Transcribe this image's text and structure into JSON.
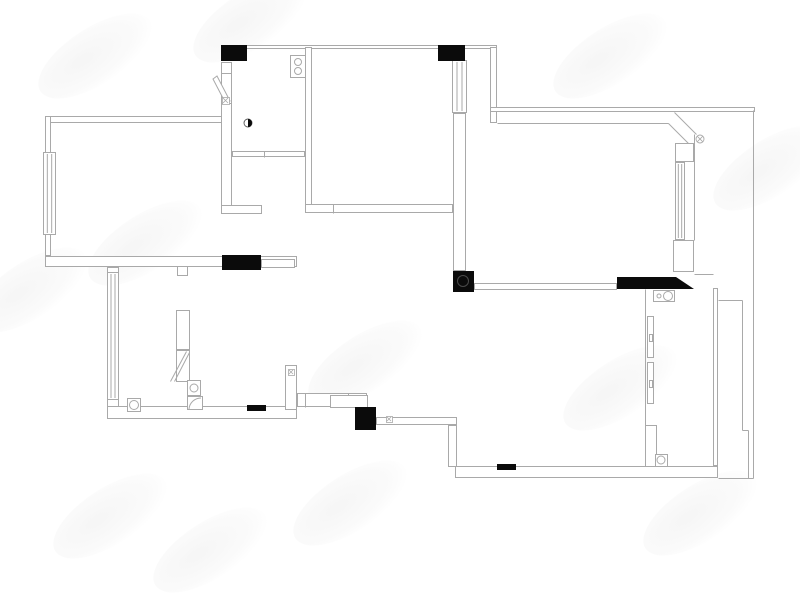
{
  "meta": {
    "kind": "apartment-floor-plan",
    "canvas": {
      "width": 800,
      "height": 567
    },
    "background": "#ffffff"
  },
  "colors": {
    "line": "#a9a9a9",
    "dark": "#0b0b0b",
    "white": "#ffffff",
    "pipe_ring": "#4a4a4a"
  },
  "watermarks": [
    {
      "x": 30,
      "y": 28
    },
    {
      "x": 185,
      "y": -8
    },
    {
      "x": 545,
      "y": 28
    },
    {
      "x": 705,
      "y": 140
    },
    {
      "x": -35,
      "y": 262
    },
    {
      "x": 80,
      "y": 215
    },
    {
      "x": 300,
      "y": 335
    },
    {
      "x": 555,
      "y": 360
    },
    {
      "x": 285,
      "y": 475
    },
    {
      "x": 635,
      "y": 485
    },
    {
      "x": 145,
      "y": 522
    },
    {
      "x": 45,
      "y": 488
    }
  ],
  "plan": {
    "shapes": [
      {
        "t": "rect",
        "n": "top-wall",
        "x": 221,
        "y": 45,
        "w": 276,
        "h": 4
      },
      {
        "t": "rect",
        "n": "left-room-top-wall",
        "x": 45,
        "y": 116,
        "w": 177,
        "h": 7
      },
      {
        "t": "rect",
        "n": "left-room-left-wall",
        "x": 45,
        "y": 116,
        "w": 6,
        "h": 140
      },
      {
        "t": "win",
        "n": "window",
        "x": 43,
        "y": 152,
        "w": 13,
        "h": 83
      },
      {
        "t": "rect",
        "n": "left-room-bottom-wall",
        "x": 45,
        "y": 256,
        "w": 252,
        "h": 11
      },
      {
        "t": "rect",
        "n": "door-lintel",
        "x": 261,
        "y": 259,
        "w": 34,
        "h": 9
      },
      {
        "t": "rect",
        "n": "wall-notch",
        "x": 177,
        "y": 266,
        "w": 11,
        "h": 10
      },
      {
        "t": "rect",
        "n": "entry-door-jamb",
        "x": 221,
        "y": 62,
        "w": 11,
        "h": 12
      },
      {
        "t": "rect",
        "n": "entry-door-frame",
        "x": 221,
        "y": 73,
        "w": 11,
        "h": 32
      },
      {
        "t": "poly",
        "n": "entry-door-leaf",
        "fill": "none",
        "pts": [
          [
            213,
            79
          ],
          [
            217,
            76
          ],
          [
            230,
            101
          ],
          [
            226,
            104
          ]
        ]
      },
      {
        "t": "rect",
        "n": "kitchen-left-wall",
        "x": 221,
        "y": 103,
        "w": 11,
        "h": 107
      },
      {
        "t": "rect",
        "n": "bath-bottom-stub-left",
        "x": 221,
        "y": 205,
        "w": 41,
        "h": 9
      },
      {
        "t": "rect",
        "n": "kitchen-right-wall",
        "x": 305,
        "y": 47,
        "w": 7,
        "h": 158
      },
      {
        "t": "rect",
        "n": "kitchen-bottom-wall",
        "x": 232,
        "y": 151,
        "w": 73,
        "h": 6
      },
      {
        "t": "line",
        "n": "wall-tick",
        "x1": 264,
        "y1": 151,
        "x2": 264,
        "y2": 157
      },
      {
        "t": "rect",
        "n": "living-bottom-wall",
        "x": 305,
        "y": 204,
        "w": 148,
        "h": 9
      },
      {
        "t": "line",
        "n": "wall-tick",
        "x1": 333,
        "y1": 204,
        "x2": 333,
        "y2": 213
      },
      {
        "t": "rect",
        "n": "stove",
        "x": 290,
        "y": 55,
        "w": 16,
        "h": 23
      },
      {
        "t": "circle",
        "n": "stove-burner",
        "cx": 298,
        "cy": 62,
        "r": 3.5
      },
      {
        "t": "circle",
        "n": "stove-burner",
        "cx": 298,
        "cy": 71,
        "r": 3.5
      },
      {
        "t": "sym",
        "n": "meter-symbol",
        "x": 222,
        "y": 97,
        "s": 7
      },
      {
        "t": "rect",
        "n": "lower-left-wall",
        "x": 107,
        "y": 267,
        "w": 12,
        "h": 151
      },
      {
        "t": "win",
        "n": "window",
        "x": 107,
        "y": 272,
        "w": 12,
        "h": 128
      },
      {
        "t": "rect",
        "n": "lower-left-bottom-wall",
        "x": 107,
        "y": 406,
        "w": 190,
        "h": 13
      },
      {
        "t": "rect",
        "n": "floor-drain",
        "x": 127,
        "y": 398,
        "w": 14,
        "h": 14
      },
      {
        "t": "circle",
        "n": "floor-drain-circle",
        "cx": 134,
        "cy": 405,
        "r": 4.5
      },
      {
        "t": "rect",
        "n": "cabinet",
        "x": 176,
        "y": 310,
        "w": 14,
        "h": 40
      },
      {
        "t": "rect",
        "n": "water-heater",
        "x": 176,
        "y": 350,
        "w": 14,
        "h": 32
      },
      {
        "t": "line",
        "n": "brace",
        "x1": 170,
        "y1": 381,
        "x2": 186,
        "y2": 351
      },
      {
        "t": "line",
        "n": "brace",
        "x1": 174,
        "y1": 381,
        "x2": 189,
        "y2": 352
      },
      {
        "t": "rect",
        "n": "toilet-tank",
        "x": 187,
        "y": 380,
        "w": 14,
        "h": 16
      },
      {
        "t": "circle",
        "n": "toilet-circle",
        "cx": 194,
        "cy": 388,
        "r": 4
      },
      {
        "t": "rect",
        "n": "corner-basin",
        "x": 187,
        "y": 396,
        "w": 16,
        "h": 14
      },
      {
        "t": "arc",
        "n": "corner-basin-arc",
        "d": "M 189 409 A 12 12 0 0 1 201 398"
      },
      {
        "t": "rect",
        "n": "hall-jamb",
        "x": 285,
        "y": 365,
        "w": 12,
        "h": 45
      },
      {
        "t": "sym",
        "n": "switch-symbol",
        "x": 288,
        "y": 369,
        "s": 6
      },
      {
        "t": "rect",
        "n": "hall-wall",
        "x": 297,
        "y": 393,
        "w": 70,
        "h": 14
      },
      {
        "t": "line",
        "n": "wall-tick",
        "x1": 305,
        "y1": 393,
        "x2": 305,
        "y2": 407
      },
      {
        "t": "line",
        "n": "wall-tick",
        "x1": 348,
        "y1": 393,
        "x2": 348,
        "y2": 407
      },
      {
        "t": "rect",
        "n": "step-wall",
        "x": 330,
        "y": 395,
        "w": 38,
        "h": 13
      },
      {
        "t": "rect",
        "n": "hall-wall-lower",
        "x": 376,
        "y": 417,
        "w": 81,
        "h": 8
      },
      {
        "t": "sym",
        "n": "switch-symbol",
        "x": 386,
        "y": 416,
        "s": 6
      },
      {
        "t": "rect",
        "n": "hall-wall-vert",
        "x": 448,
        "y": 425,
        "w": 9,
        "h": 42
      },
      {
        "t": "win",
        "n": "window",
        "x": 452,
        "y": 60,
        "w": 15,
        "h": 53
      },
      {
        "t": "rect",
        "n": "bedroom-left-wall",
        "x": 453,
        "y": 113,
        "w": 13,
        "h": 158
      },
      {
        "t": "rect",
        "n": "vestibule-right-wall",
        "x": 490,
        "y": 47,
        "w": 7,
        "h": 76
      },
      {
        "t": "rect",
        "n": "outer-top-wall",
        "x": 490,
        "y": 107,
        "w": 265,
        "h": 5
      },
      {
        "t": "line",
        "n": "bedroom-top-wall",
        "x1": 497,
        "y1": 123,
        "x2": 668,
        "y2": 123
      },
      {
        "t": "line",
        "n": "chamfer-inner",
        "x1": 668,
        "y1": 123,
        "x2": 690,
        "y2": 145
      },
      {
        "t": "line",
        "n": "chamfer-outer",
        "x1": 674,
        "y1": 112,
        "x2": 696,
        "y2": 134
      },
      {
        "t": "rect",
        "n": "bedroom-corner-block",
        "x": 675,
        "y": 143,
        "w": 19,
        "h": 19
      },
      {
        "t": "cx",
        "n": "pipe-symbol",
        "cx": 700,
        "cy": 139,
        "r": 4
      },
      {
        "t": "win",
        "n": "window",
        "x": 675,
        "y": 162,
        "w": 10,
        "h": 78
      },
      {
        "t": "line",
        "n": "bedroom-right-wall-outer",
        "x1": 694,
        "y1": 134,
        "x2": 694,
        "y2": 240
      },
      {
        "t": "rect",
        "n": "window-sill-block",
        "x": 673,
        "y": 240,
        "w": 21,
        "h": 32
      },
      {
        "t": "rect",
        "n": "bedroom-bottom-wall",
        "x": 474,
        "y": 283,
        "w": 143,
        "h": 7
      },
      {
        "t": "line",
        "n": "connector",
        "x1": 694,
        "y1": 274,
        "x2": 713,
        "y2": 274
      },
      {
        "t": "rect",
        "n": "balcony-fixture",
        "x": 653,
        "y": 290,
        "w": 22,
        "h": 12
      },
      {
        "t": "circle",
        "n": "fixture-circle",
        "cx": 659,
        "cy": 296,
        "r": 2
      },
      {
        "t": "circle",
        "n": "fixture-circle",
        "cx": 668,
        "cy": 296,
        "r": 4.5
      },
      {
        "t": "line",
        "n": "balcony-left-wall",
        "x1": 645,
        "y1": 289,
        "x2": 645,
        "y2": 470
      },
      {
        "t": "rect",
        "n": "sliding-panel",
        "x": 647,
        "y": 316,
        "w": 7,
        "h": 42
      },
      {
        "t": "rect",
        "n": "panel-handle",
        "x": 649,
        "y": 334,
        "w": 4,
        "h": 8
      },
      {
        "t": "rect",
        "n": "sliding-panel",
        "x": 647,
        "y": 362,
        "w": 7,
        "h": 42
      },
      {
        "t": "rect",
        "n": "panel-handle",
        "x": 649,
        "y": 380,
        "w": 4,
        "h": 8
      },
      {
        "t": "rect",
        "n": "balcony-left-corner",
        "x": 645,
        "y": 425,
        "w": 12,
        "h": 45
      },
      {
        "t": "rect",
        "n": "balcony-drain",
        "x": 655,
        "y": 454,
        "w": 13,
        "h": 13
      },
      {
        "t": "circle",
        "n": "balcony-drain-circle",
        "cx": 661,
        "cy": 460,
        "r": 4
      },
      {
        "t": "rect",
        "n": "balcony-right-wall",
        "x": 713,
        "y": 288,
        "w": 5,
        "h": 178
      },
      {
        "t": "rect",
        "n": "bottom-outer-wall",
        "x": 455,
        "y": 466,
        "w": 263,
        "h": 12
      },
      {
        "t": "line",
        "n": "outer-boundary-right",
        "x1": 753,
        "y1": 110,
        "x2": 753,
        "y2": 478
      },
      {
        "t": "line",
        "n": "outer-boundary-bottom",
        "x1": 718,
        "y1": 478,
        "x2": 753,
        "y2": 478
      },
      {
        "t": "line",
        "n": "ac-ledge",
        "x1": 718,
        "y1": 300,
        "x2": 742,
        "y2": 300
      },
      {
        "t": "line",
        "n": "ac-ledge",
        "x1": 742,
        "y1": 300,
        "x2": 742,
        "y2": 430
      },
      {
        "t": "line",
        "n": "ac-ledge",
        "x1": 742,
        "y1": 430,
        "x2": 748,
        "y2": 430
      },
      {
        "t": "line",
        "n": "ac-ledge",
        "x1": 748,
        "y1": 430,
        "x2": 748,
        "y2": 478
      },
      {
        "t": "solid",
        "n": "column",
        "x": 221,
        "y": 45,
        "w": 26,
        "h": 16
      },
      {
        "t": "solid",
        "n": "column",
        "x": 438,
        "y": 45,
        "w": 27,
        "h": 16
      },
      {
        "t": "solid",
        "n": "column",
        "x": 222,
        "y": 255,
        "w": 39,
        "h": 15
      },
      {
        "t": "solid",
        "n": "column",
        "x": 355,
        "y": 407,
        "w": 21,
        "h": 23
      },
      {
        "t": "solid",
        "n": "column",
        "x": 453,
        "y": 271,
        "w": 21,
        "h": 21
      },
      {
        "t": "circle",
        "n": "column-pipe",
        "cx": 463,
        "cy": 281,
        "r": 5.5,
        "stroke": "pipe_ring"
      },
      {
        "t": "poly",
        "n": "balcony-lintel",
        "fill": "dark",
        "pts": [
          [
            617,
            277
          ],
          [
            676,
            277
          ],
          [
            694,
            289
          ],
          [
            617,
            289
          ]
        ]
      },
      {
        "t": "solid",
        "n": "threshold",
        "x": 247,
        "y": 405,
        "w": 19,
        "h": 6
      },
      {
        "t": "solid",
        "n": "threshold",
        "x": 497,
        "y": 464,
        "w": 19,
        "h": 6
      },
      {
        "t": "half",
        "n": "door-stop",
        "cx": 248,
        "cy": 123,
        "r": 4
      }
    ]
  }
}
